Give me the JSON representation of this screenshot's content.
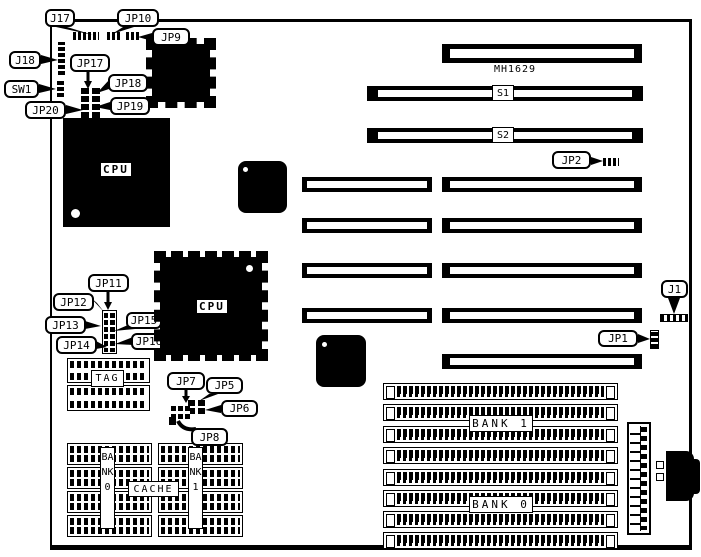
{
  "diagram": {
    "model": "MH1629"
  },
  "callouts": {
    "j17": "J17",
    "jp10": "JP10",
    "jp9": "JP9",
    "j18": "J18",
    "sw1": "SW1",
    "jp17": "JP17",
    "jp18": "JP18",
    "jp19": "JP19",
    "jp20": "JP20",
    "jp11": "JP11",
    "jp12": "JP12",
    "jp13": "JP13",
    "jp14": "JP14",
    "jp15": "JP15",
    "jp16": "JP16",
    "jp7": "JP7",
    "jp5": "JP5",
    "jp6": "JP6",
    "jp8": "JP8",
    "jp2": "JP2",
    "j1": "J1",
    "jp1": "JP1"
  },
  "chips": {
    "cpu1": "CPU",
    "cpu2": "CPU"
  },
  "slots": {
    "s1": "S1",
    "s2": "S2"
  },
  "memory": {
    "tag": "TAG",
    "cache": "CACHE",
    "cache_bank0": "BANK0",
    "cache_bank1": "BANK1",
    "simm_bank1": "BANK 1",
    "simm_bank0": "BANK 0"
  },
  "colors": {
    "ink": "#000000",
    "background": "#ffffff"
  }
}
